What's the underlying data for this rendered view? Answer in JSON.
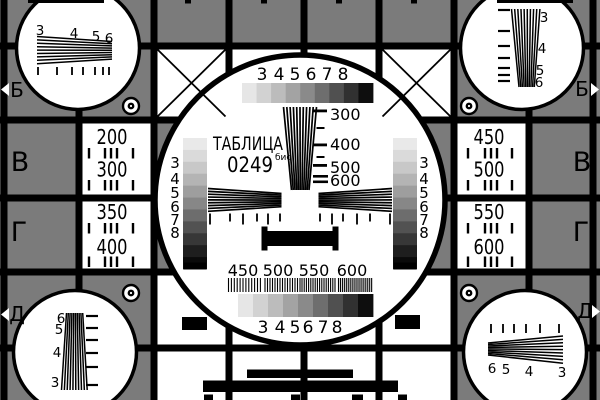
{
  "card": {
    "title": "ТАБЛИЦА",
    "code": "0249",
    "code_suffix": "бис"
  },
  "row_letters": {
    "left": [
      "Б",
      "В",
      "Г",
      "Д"
    ],
    "right": [
      "Б",
      "В",
      "Г",
      "Д"
    ]
  },
  "side_panels": {
    "left": [
      {
        "top": "200",
        "bottom": "300"
      },
      {
        "top": "350",
        "bottom": "400"
      }
    ],
    "right": [
      {
        "top": "450",
        "bottom": "500"
      },
      {
        "top": "550",
        "bottom": "600"
      }
    ]
  },
  "center_scales": {
    "top_numbers": [
      "3",
      "4",
      "5",
      "6",
      "7",
      "8"
    ],
    "bottom_numbers": [
      "3",
      "4",
      "5",
      "6",
      "7",
      "8"
    ],
    "left_numbers": [
      "3",
      "4",
      "5",
      "6",
      "7",
      "8"
    ],
    "right_numbers": [
      "3",
      "4",
      "5",
      "6",
      "7",
      "8"
    ],
    "vertical_wedge_labels": [
      "300",
      "400",
      "500",
      "600"
    ],
    "grating_labels": [
      "450",
      "500",
      "550",
      "600"
    ]
  },
  "corner_wedge_numbers": {
    "top_left": [
      "3",
      "4",
      "5",
      "6"
    ],
    "top_right": [
      "3",
      "4",
      "5",
      "6"
    ],
    "bottom_left": [
      "6",
      "5",
      "4",
      "3"
    ],
    "bottom_right": [
      "6",
      "5",
      "4",
      "3"
    ]
  },
  "colors": {
    "background": "#7b7b7b",
    "ink": "#000000",
    "paper": "#ffffff",
    "grayscale_9": [
      "#e6e6e6",
      "#d2d2d2",
      "#bcbcbc",
      "#a3a3a3",
      "#8a8a8a",
      "#6e6e6e",
      "#505050",
      "#313131",
      "#0e0e0e"
    ],
    "grayscale_11": [
      "#e9e9e9",
      "#dadada",
      "#c8c8c8",
      "#b4b4b4",
      "#9e9e9e",
      "#878787",
      "#6d6d6d",
      "#525252",
      "#373737",
      "#1e1e1e",
      "#0a0a0a"
    ]
  }
}
